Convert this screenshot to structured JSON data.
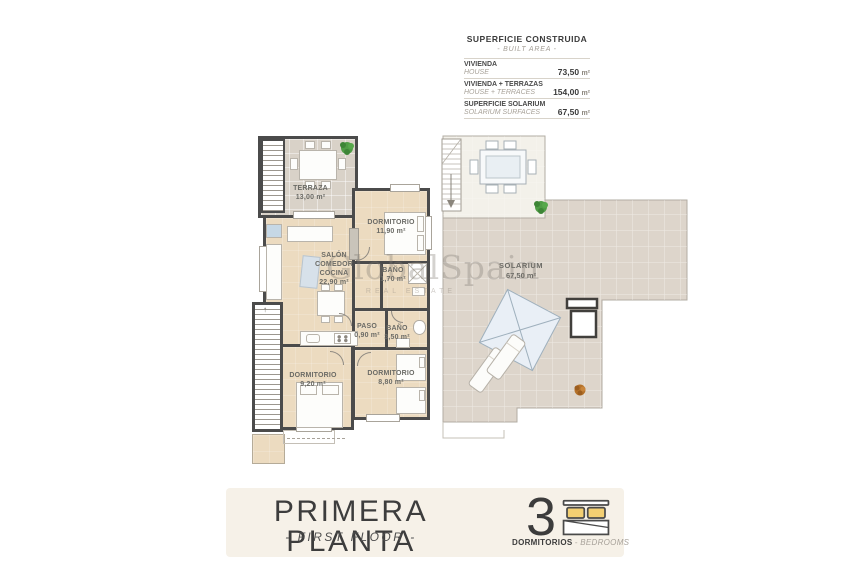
{
  "legend": {
    "title": "SUPERFICIE CONSTRUIDA",
    "subtitle": "- BUILT AREA -",
    "rows": [
      {
        "label": "VIVIENDA",
        "sublabel": "HOUSE",
        "value": "73,50",
        "unit": "m²"
      },
      {
        "label": "VIVIENDA + TERRAZAS",
        "sublabel": "HOUSE + TERRACES",
        "value": "154,00",
        "unit": "m²"
      },
      {
        "label": "SUPERFICIE SOLARIUM",
        "sublabel": "SOLARIUM SURFACES",
        "value": "67,50",
        "unit": "m²"
      }
    ]
  },
  "plan_left": {
    "rooms": {
      "terraza": {
        "name": "TERRAZA",
        "area": "13,00 m²"
      },
      "salon": {
        "line1": "SALÓN",
        "line2": "COMEDOR",
        "line3": "COCINA",
        "area": "22,90 m²"
      },
      "dormitorio_principal": {
        "name": "DORMITORIO",
        "area": "11,90 m²"
      },
      "bano_pequeno": {
        "name": "BAÑO",
        "area": "1,70 m²"
      },
      "paso": {
        "name": "PASO",
        "area": "0,90 m²"
      },
      "bano": {
        "name": "BAÑO",
        "area": "3,50 m²"
      },
      "dormitorio_2": {
        "name": "DORMITORIO",
        "area": "9,20 m²"
      },
      "dormitorio_3": {
        "name": "DORMITORIO",
        "area": "8,80 m²"
      }
    }
  },
  "plan_right": {
    "solarium": {
      "name": "SOLARIUM",
      "area": "67,50 m²"
    }
  },
  "watermark": {
    "brand": "GlobalSpain",
    "tagline": "REAL ESTATE"
  },
  "footer": {
    "title": "PRIMERA PLANTA",
    "subtitle": "- FIRST FLOOR -",
    "bedrooms_count": "3",
    "bedrooms_label": "DORMITORIOS",
    "bedrooms_sublabel": "- BEDROOMS"
  },
  "colors": {
    "wall": "#4b4b4b",
    "floor_interior": "#ecdbc0",
    "floor_terrace": "#d9d2c8",
    "floor_solarium": "#ddd6cc",
    "pillow_yellow": "#f3cf72",
    "banner_bg": "#f6f1e8",
    "text_dark": "#3d3d3d",
    "text_muted": "#a39d94"
  }
}
